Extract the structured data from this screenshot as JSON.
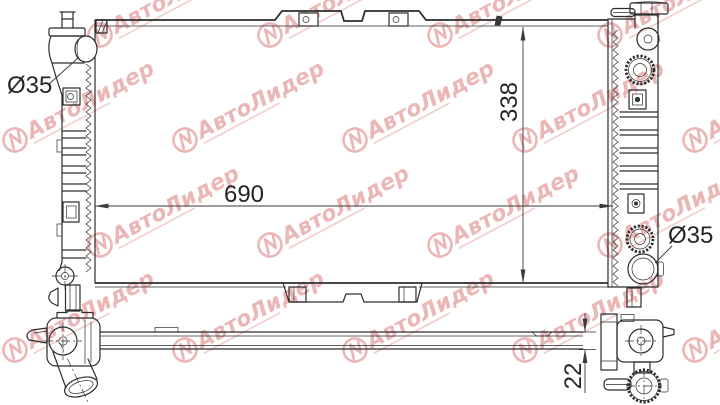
{
  "drawing": {
    "type": "radiator-technical-drawing",
    "dimensions": {
      "width": {
        "value": "690"
      },
      "height": {
        "value": "338"
      },
      "inlet": {
        "value": "Ø35"
      },
      "outlet": {
        "value": "Ø35"
      },
      "thickness": {
        "value": "22"
      }
    }
  },
  "watermark": {
    "brand": "АвтоЛидер",
    "color": "#d97070",
    "opacity": 0.5
  },
  "colors": {
    "line": "#2d2d2d",
    "background": "#ffffff"
  }
}
